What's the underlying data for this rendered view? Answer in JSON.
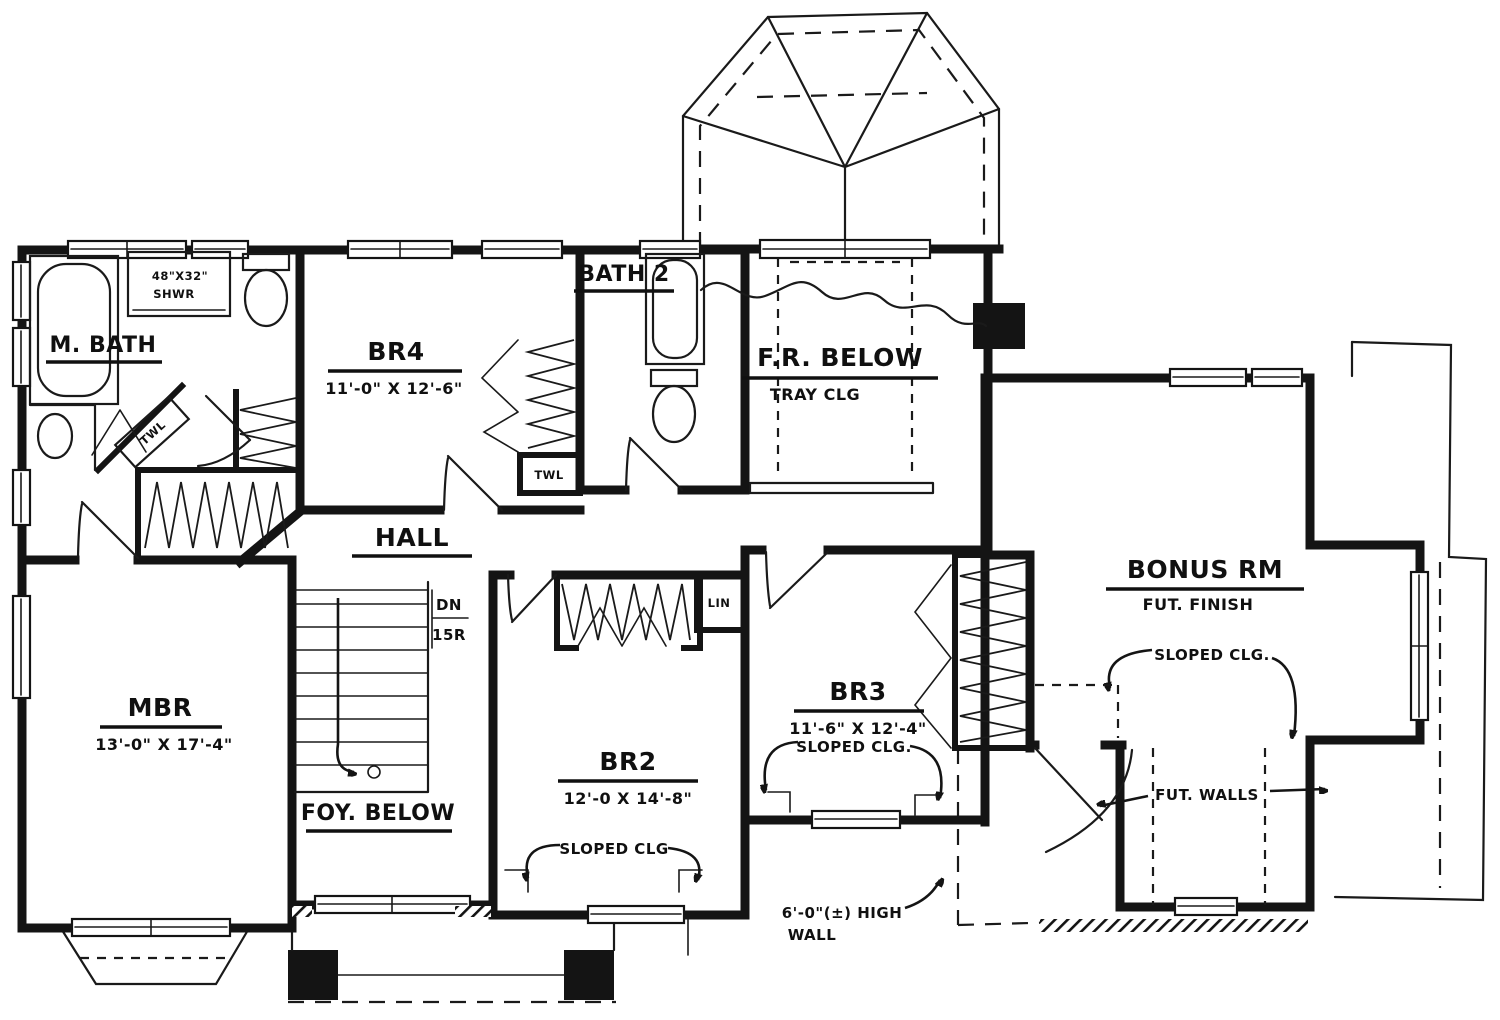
{
  "plan": {
    "kind": "hand-drawn second floor plan",
    "ink_color": "#141414",
    "background": "#ffffff"
  },
  "rooms": {
    "mbath": {
      "name": "M. BATH"
    },
    "br4": {
      "name": "BR4",
      "dims": "11'-0\" X 12'-6\""
    },
    "bath2": {
      "name": "BATH 2"
    },
    "family": {
      "name": "F.R. BELOW",
      "note": "TRAY CLG"
    },
    "hall": {
      "name": "HALL"
    },
    "mbr": {
      "name": "MBR",
      "dims": "13'-0\" X 17'-4\""
    },
    "foyer": {
      "name": "FOY. BELOW"
    },
    "br2": {
      "name": "BR2",
      "dims": "12'-0 X 14'-8\""
    },
    "br3": {
      "name": "BR3",
      "dims": "11'-6\" X 12'-4\""
    },
    "bonus": {
      "name": "BONUS RM",
      "note": "FUT. FINISH"
    }
  },
  "annotations": {
    "shower_line1": "48\"X32\"",
    "shower_line2": "SHWR",
    "stairs_down": "DN",
    "stairs_risers": "15R",
    "linen_closet": "LIN",
    "towel_closet_mbath": "TWL",
    "towel_closet_hall": "TWL",
    "sloped_clg_br2": "SLOPED CLG",
    "sloped_clg_br3": "SLOPED CLG.",
    "sloped_clg_bonus": "SLOPED CLG.",
    "future_walls": "FUT. WALLS",
    "high_wall_line1": "6'-0\"(±) HIGH",
    "high_wall_line2": "WALL"
  }
}
